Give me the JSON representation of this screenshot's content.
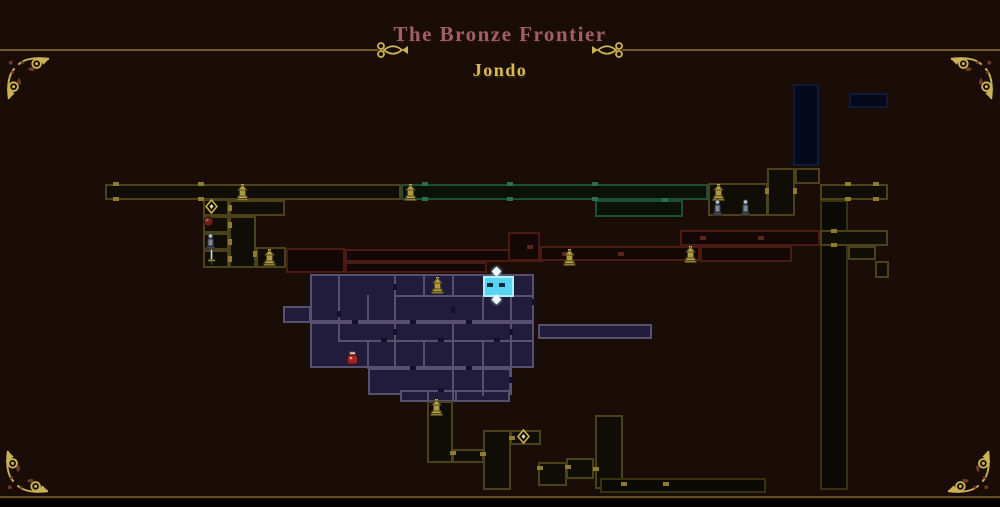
{
  "header": {
    "region_title": "The Bronze Frontier",
    "location_title": "Jondo"
  },
  "colors": {
    "background": "#1a0d08",
    "frame_line": "#6e5c24",
    "ornament_gold": "#c9b355",
    "title_rose": "#9d6067",
    "subtitle_gold": "#d9bb55",
    "current_room_cyan": "#57d5f1"
  },
  "styles": {
    "p": {
      "fill": "#221c3c",
      "border": "#58506f"
    },
    "c": {
      "fill": "#57d5f1",
      "border": "#aeeffb"
    },
    "o": {
      "fill": "#100d06",
      "border": "#4b421c"
    },
    "od": {
      "fill": "#0c0a05",
      "border": "#39320f"
    },
    "t": {
      "fill": "#091109",
      "border": "#1e4f36"
    },
    "n": {
      "fill": "#04091b",
      "border": "#0e1c36"
    },
    "r": {
      "fill": "#130806",
      "border": "#4b1a12"
    }
  },
  "door_colors": {
    "gold": "#8f7b2e",
    "green": "#2d6f4b",
    "red": "#5d241a",
    "slot": "#12102a",
    "cyanslot": "#0e2b3d"
  },
  "map": {
    "rooms": [
      [
        105,
        184,
        296,
        16,
        "o"
      ],
      [
        203,
        199,
        26,
        17,
        "o"
      ],
      [
        229,
        200,
        56,
        16,
        "o"
      ],
      [
        203,
        216,
        26,
        17,
        "o"
      ],
      [
        203,
        233,
        26,
        17,
        "o"
      ],
      [
        203,
        250,
        26,
        18,
        "o"
      ],
      [
        229,
        216,
        27,
        52,
        "o"
      ],
      [
        256,
        247,
        30,
        21,
        "o"
      ],
      [
        286,
        248,
        59,
        25,
        "r"
      ],
      [
        345,
        249,
        198,
        13,
        "r"
      ],
      [
        345,
        262,
        142,
        11,
        "r"
      ],
      [
        401,
        184,
        307,
        16,
        "t"
      ],
      [
        595,
        200,
        88,
        17,
        "t"
      ],
      [
        793,
        84,
        26,
        82,
        "n"
      ],
      [
        849,
        93,
        39,
        15,
        "n"
      ],
      [
        708,
        183,
        60,
        33,
        "o"
      ],
      [
        767,
        168,
        28,
        48,
        "o"
      ],
      [
        795,
        168,
        25,
        16,
        "o"
      ],
      [
        820,
        184,
        68,
        16,
        "o"
      ],
      [
        820,
        200,
        28,
        290,
        "od"
      ],
      [
        820,
        230,
        68,
        16,
        "o"
      ],
      [
        848,
        246,
        28,
        14,
        "o"
      ],
      [
        875,
        261,
        14,
        17,
        "o"
      ],
      [
        680,
        230,
        140,
        16,
        "r"
      ],
      [
        700,
        246,
        92,
        16,
        "r"
      ],
      [
        508,
        232,
        32,
        29,
        "r"
      ],
      [
        540,
        246,
        160,
        15,
        "r"
      ],
      [
        283,
        306,
        28,
        17,
        "p"
      ],
      [
        310,
        274,
        86,
        48,
        "p"
      ],
      [
        394,
        274,
        140,
        48,
        "p"
      ],
      [
        310,
        322,
        224,
        46,
        "p"
      ],
      [
        368,
        368,
        143,
        27,
        "p"
      ],
      [
        400,
        390,
        110,
        12,
        "p"
      ],
      [
        538,
        324,
        114,
        15,
        "p"
      ],
      [
        427,
        401,
        26,
        62,
        "o"
      ],
      [
        452,
        449,
        32,
        14,
        "o"
      ],
      [
        483,
        430,
        28,
        60,
        "o"
      ],
      [
        510,
        430,
        31,
        15,
        "o"
      ],
      [
        538,
        462,
        29,
        24,
        "o"
      ],
      [
        566,
        458,
        28,
        21,
        "o"
      ],
      [
        595,
        415,
        28,
        74,
        "o"
      ],
      [
        600,
        478,
        166,
        15,
        "od"
      ]
    ],
    "current_room": [
      483,
      276,
      31,
      21,
      "c"
    ],
    "walls": [
      [
        "v",
        338,
        275,
        65
      ],
      [
        "v",
        367,
        295,
        28
      ],
      [
        "v",
        394,
        275,
        94
      ],
      [
        "v",
        423,
        275,
        21
      ],
      [
        "v",
        452,
        275,
        21
      ],
      [
        "v",
        482,
        296,
        27
      ],
      [
        "v",
        510,
        296,
        99
      ],
      [
        "v",
        452,
        322,
        78
      ],
      [
        "v",
        423,
        340,
        29
      ],
      [
        "v",
        367,
        340,
        29
      ],
      [
        "v",
        482,
        340,
        29
      ],
      [
        "v",
        482,
        368,
        28
      ],
      [
        "v",
        427,
        390,
        12
      ],
      [
        "v",
        455,
        390,
        12
      ],
      [
        "h",
        394,
        295,
        140
      ],
      [
        "h",
        310,
        322,
        224
      ],
      [
        "h",
        338,
        340,
        196
      ],
      [
        "h",
        368,
        368,
        142
      ],
      [
        "h",
        400,
        390,
        110
      ]
    ],
    "doors": [
      [
        "gold",
        "h",
        113,
        182
      ],
      [
        "gold",
        "h",
        198,
        182
      ],
      [
        "gold",
        "h",
        113,
        197
      ],
      [
        "gold",
        "h",
        198,
        197
      ],
      [
        "gold",
        "v",
        228,
        205
      ],
      [
        "gold",
        "v",
        228,
        222
      ],
      [
        "gold",
        "v",
        228,
        239
      ],
      [
        "gold",
        "v",
        228,
        256
      ],
      [
        "gold",
        "v",
        253,
        251
      ],
      [
        "gold",
        "h",
        450,
        451
      ],
      [
        "gold",
        "h",
        480,
        452
      ],
      [
        "gold",
        "h",
        509,
        436
      ],
      [
        "gold",
        "h",
        537,
        466
      ],
      [
        "gold",
        "h",
        565,
        465
      ],
      [
        "gold",
        "h",
        593,
        467
      ],
      [
        "gold",
        "h",
        621,
        482
      ],
      [
        "gold",
        "h",
        663,
        482
      ],
      [
        "gold",
        "h",
        845,
        182
      ],
      [
        "gold",
        "h",
        873,
        182
      ],
      [
        "gold",
        "h",
        845,
        197
      ],
      [
        "gold",
        "h",
        873,
        197
      ],
      [
        "gold",
        "h",
        831,
        229
      ],
      [
        "gold",
        "h",
        831,
        243
      ],
      [
        "gold",
        "v",
        765,
        188
      ],
      [
        "gold",
        "v",
        793,
        188
      ],
      [
        "green",
        "h",
        422,
        182
      ],
      [
        "green",
        "h",
        507,
        182
      ],
      [
        "green",
        "h",
        592,
        182
      ],
      [
        "green",
        "h",
        422,
        197
      ],
      [
        "green",
        "h",
        507,
        197
      ],
      [
        "green",
        "h",
        592,
        197
      ],
      [
        "green",
        "h",
        662,
        198
      ],
      [
        "red",
        "h",
        527,
        245
      ],
      [
        "red",
        "h",
        562,
        252
      ],
      [
        "red",
        "h",
        618,
        252
      ],
      [
        "red",
        "h",
        700,
        236
      ],
      [
        "red",
        "h",
        758,
        236
      ],
      [
        "slot",
        "h",
        352,
        320
      ],
      [
        "slot",
        "h",
        410,
        320
      ],
      [
        "slot",
        "h",
        466,
        320
      ],
      [
        "slot",
        "h",
        381,
        338
      ],
      [
        "slot",
        "h",
        438,
        338
      ],
      [
        "slot",
        "h",
        494,
        338
      ],
      [
        "slot",
        "h",
        410,
        366
      ],
      [
        "slot",
        "h",
        466,
        366
      ],
      [
        "slot",
        "h",
        438,
        388
      ],
      [
        "slot",
        "v",
        393,
        284
      ],
      [
        "slot",
        "v",
        393,
        329
      ],
      [
        "slot",
        "v",
        451,
        307
      ],
      [
        "slot",
        "v",
        509,
        329
      ],
      [
        "slot",
        "v",
        509,
        377
      ],
      [
        "slot",
        "v",
        337,
        311
      ],
      [
        "slot",
        "v",
        532,
        299
      ],
      [
        "cyanslot",
        "h",
        487,
        283
      ],
      [
        "cyanslot",
        "h",
        499,
        283
      ]
    ],
    "icons": [
      [
        "shrine-icon",
        236,
        184
      ],
      [
        "shrine-icon",
        404,
        184
      ],
      [
        "shrine-icon",
        712,
        184
      ],
      [
        "shrine-icon",
        263,
        249
      ],
      [
        "shrine-icon",
        563,
        249
      ],
      [
        "shrine-icon",
        684,
        246
      ],
      [
        "shrine-icon",
        431,
        277
      ],
      [
        "shrine-icon",
        430,
        399
      ],
      [
        "statue-icon",
        712,
        199
      ],
      [
        "statue-icon",
        740,
        199
      ],
      [
        "statue-icon",
        205,
        233
      ],
      [
        "sword-icon",
        207,
        249
      ],
      [
        "orb-icon",
        203,
        216
      ],
      [
        "diamond-icon",
        205,
        199
      ],
      [
        "diamond-icon",
        517,
        429
      ],
      [
        "jar-icon",
        346,
        351
      ]
    ],
    "current_markers": [
      [
        493,
        268
      ],
      [
        493,
        296
      ]
    ]
  }
}
